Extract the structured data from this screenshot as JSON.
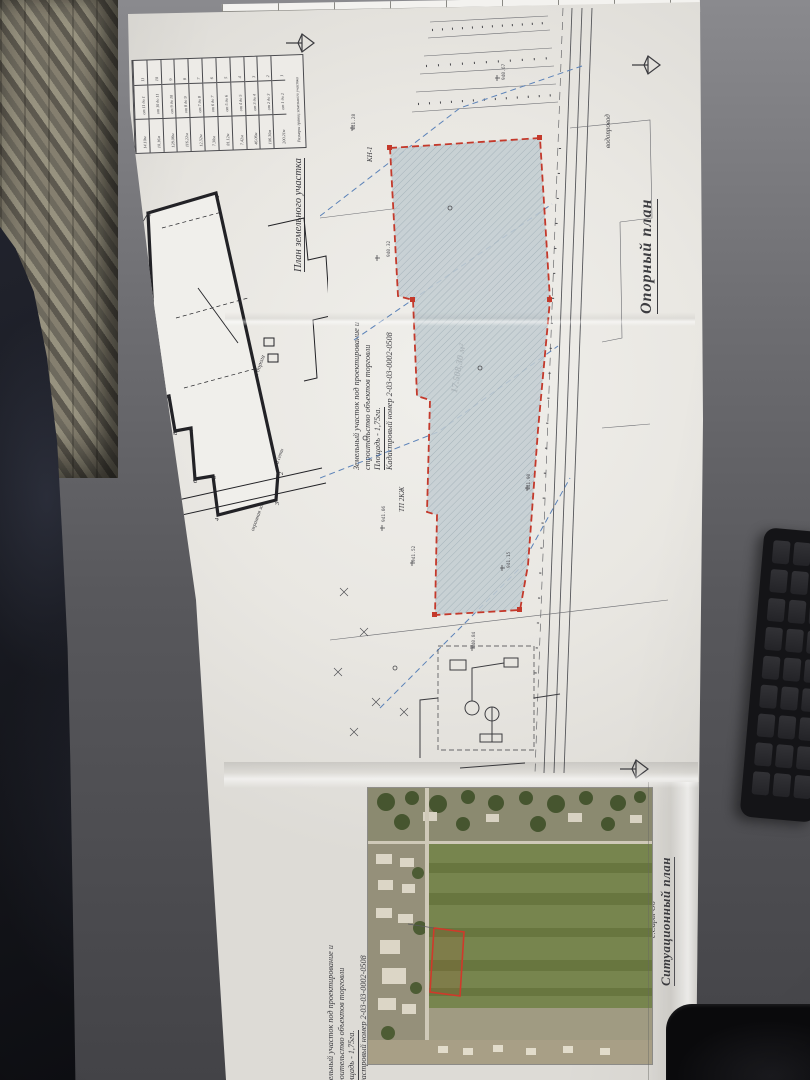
{
  "sheet": {
    "titles": {
      "main": "Опорный план",
      "situational": "Ситуационный план",
      "village": "с.Сары-Об",
      "parcel_plan": "План земельного участка"
    },
    "annotation": {
      "line1": "Земельный участок под проектирование и",
      "line2": "строительство объектов торговли",
      "line3": "Площадь - 1,75га.",
      "line4": "Кадастровый номер 2-03-03-0002-0508"
    },
    "parcel": {
      "area_label": "17.508,30 м²",
      "corner_label": "КН-1"
    },
    "labels": {
      "vodoprovod": "водопровод",
      "green_zone": "зеленая зона",
      "green_zone2": "зеленая зона",
      "road": "асфальтированная дорога",
      "guard_zone": "охранная зона канализационной сети",
      "tp": "ТП 2КЖ"
    },
    "legend_table": {
      "header": "Размеры границ земельного участка",
      "cols": [
        {
          "n": "1",
          "span": "от 1 до 2",
          "len": "200.21м"
        },
        {
          "n": "2",
          "span": "от 2 до 3",
          "len": "106.30м"
        },
        {
          "n": "3",
          "span": "от 3 до 4",
          "len": "46.06м"
        },
        {
          "n": "4",
          "span": "от 4 до 5",
          "len": "7.42м"
        },
        {
          "n": "5",
          "span": "от 5 до 6",
          "len": "81.12м"
        },
        {
          "n": "6",
          "span": "от 6 до 7",
          "len": "7.30м"
        },
        {
          "n": "7",
          "span": "от 7 до 8",
          "len": "12.32м"
        },
        {
          "n": "8",
          "span": "от 8 до 9",
          "len": "116.22м"
        },
        {
          "n": "9",
          "span": "от 9 до 10",
          "len": "128.06м"
        },
        {
          "n": "10",
          "span": "от 10 до 11",
          "len": "10.16м"
        },
        {
          "n": "11",
          "span": "от 11 до 1",
          "len": "14.10м"
        }
      ]
    },
    "small_plan": {
      "vertices": [
        "1",
        "2",
        "3",
        "4",
        "5",
        "6",
        "7",
        "8",
        "9",
        "10",
        "11"
      ]
    },
    "micro_labels": [
      "941.28",
      "941.06",
      "940.84",
      "941.52",
      "940.67",
      "941.90",
      "940.32",
      "941.15"
    ],
    "colors": {
      "parcel_outline": "#c4392b",
      "parcel_fill": "#c2ccd1",
      "utility_blue": "#5b82b8",
      "ink": "#3c3c40",
      "paper": "#eae8e3"
    }
  }
}
